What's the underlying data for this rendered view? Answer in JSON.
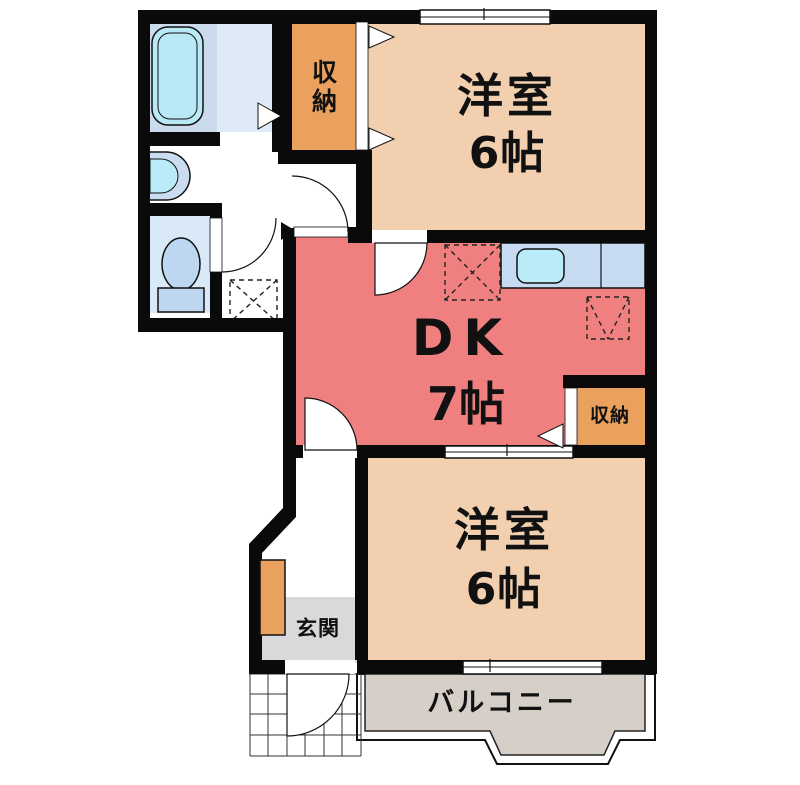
{
  "rooms": {
    "western_room_top": {
      "label": "洋室",
      "area": "6帖"
    },
    "dining_kitchen": {
      "label": "DK",
      "area": "7帖"
    },
    "western_room_bottom": {
      "label": "洋室",
      "area": "6帖"
    },
    "closet_top": {
      "label": "収納"
    },
    "closet_side": {
      "label": "収納"
    },
    "entrance": {
      "label": "玄関"
    },
    "balcony": {
      "label": "バルコニー"
    }
  },
  "colors": {
    "wall": "#0a0a0a",
    "western_room_floor": "#f2cfae",
    "dining_kitchen_floor": "#f08080",
    "closet_floor": "#eba15e",
    "bathroom_floor": "#dfeaf7",
    "bath_panel": "#ccdaee",
    "bathtub": "#b9e9f7",
    "toilet_floor": "#d9e9f7",
    "fixture_blue": "#bdd7f0",
    "kitchen_counter": "#c6daf2",
    "sink": "#b9ecf8",
    "entrance_floor": "#d9d9dc",
    "balcony_floor": "#d6cfc8"
  }
}
